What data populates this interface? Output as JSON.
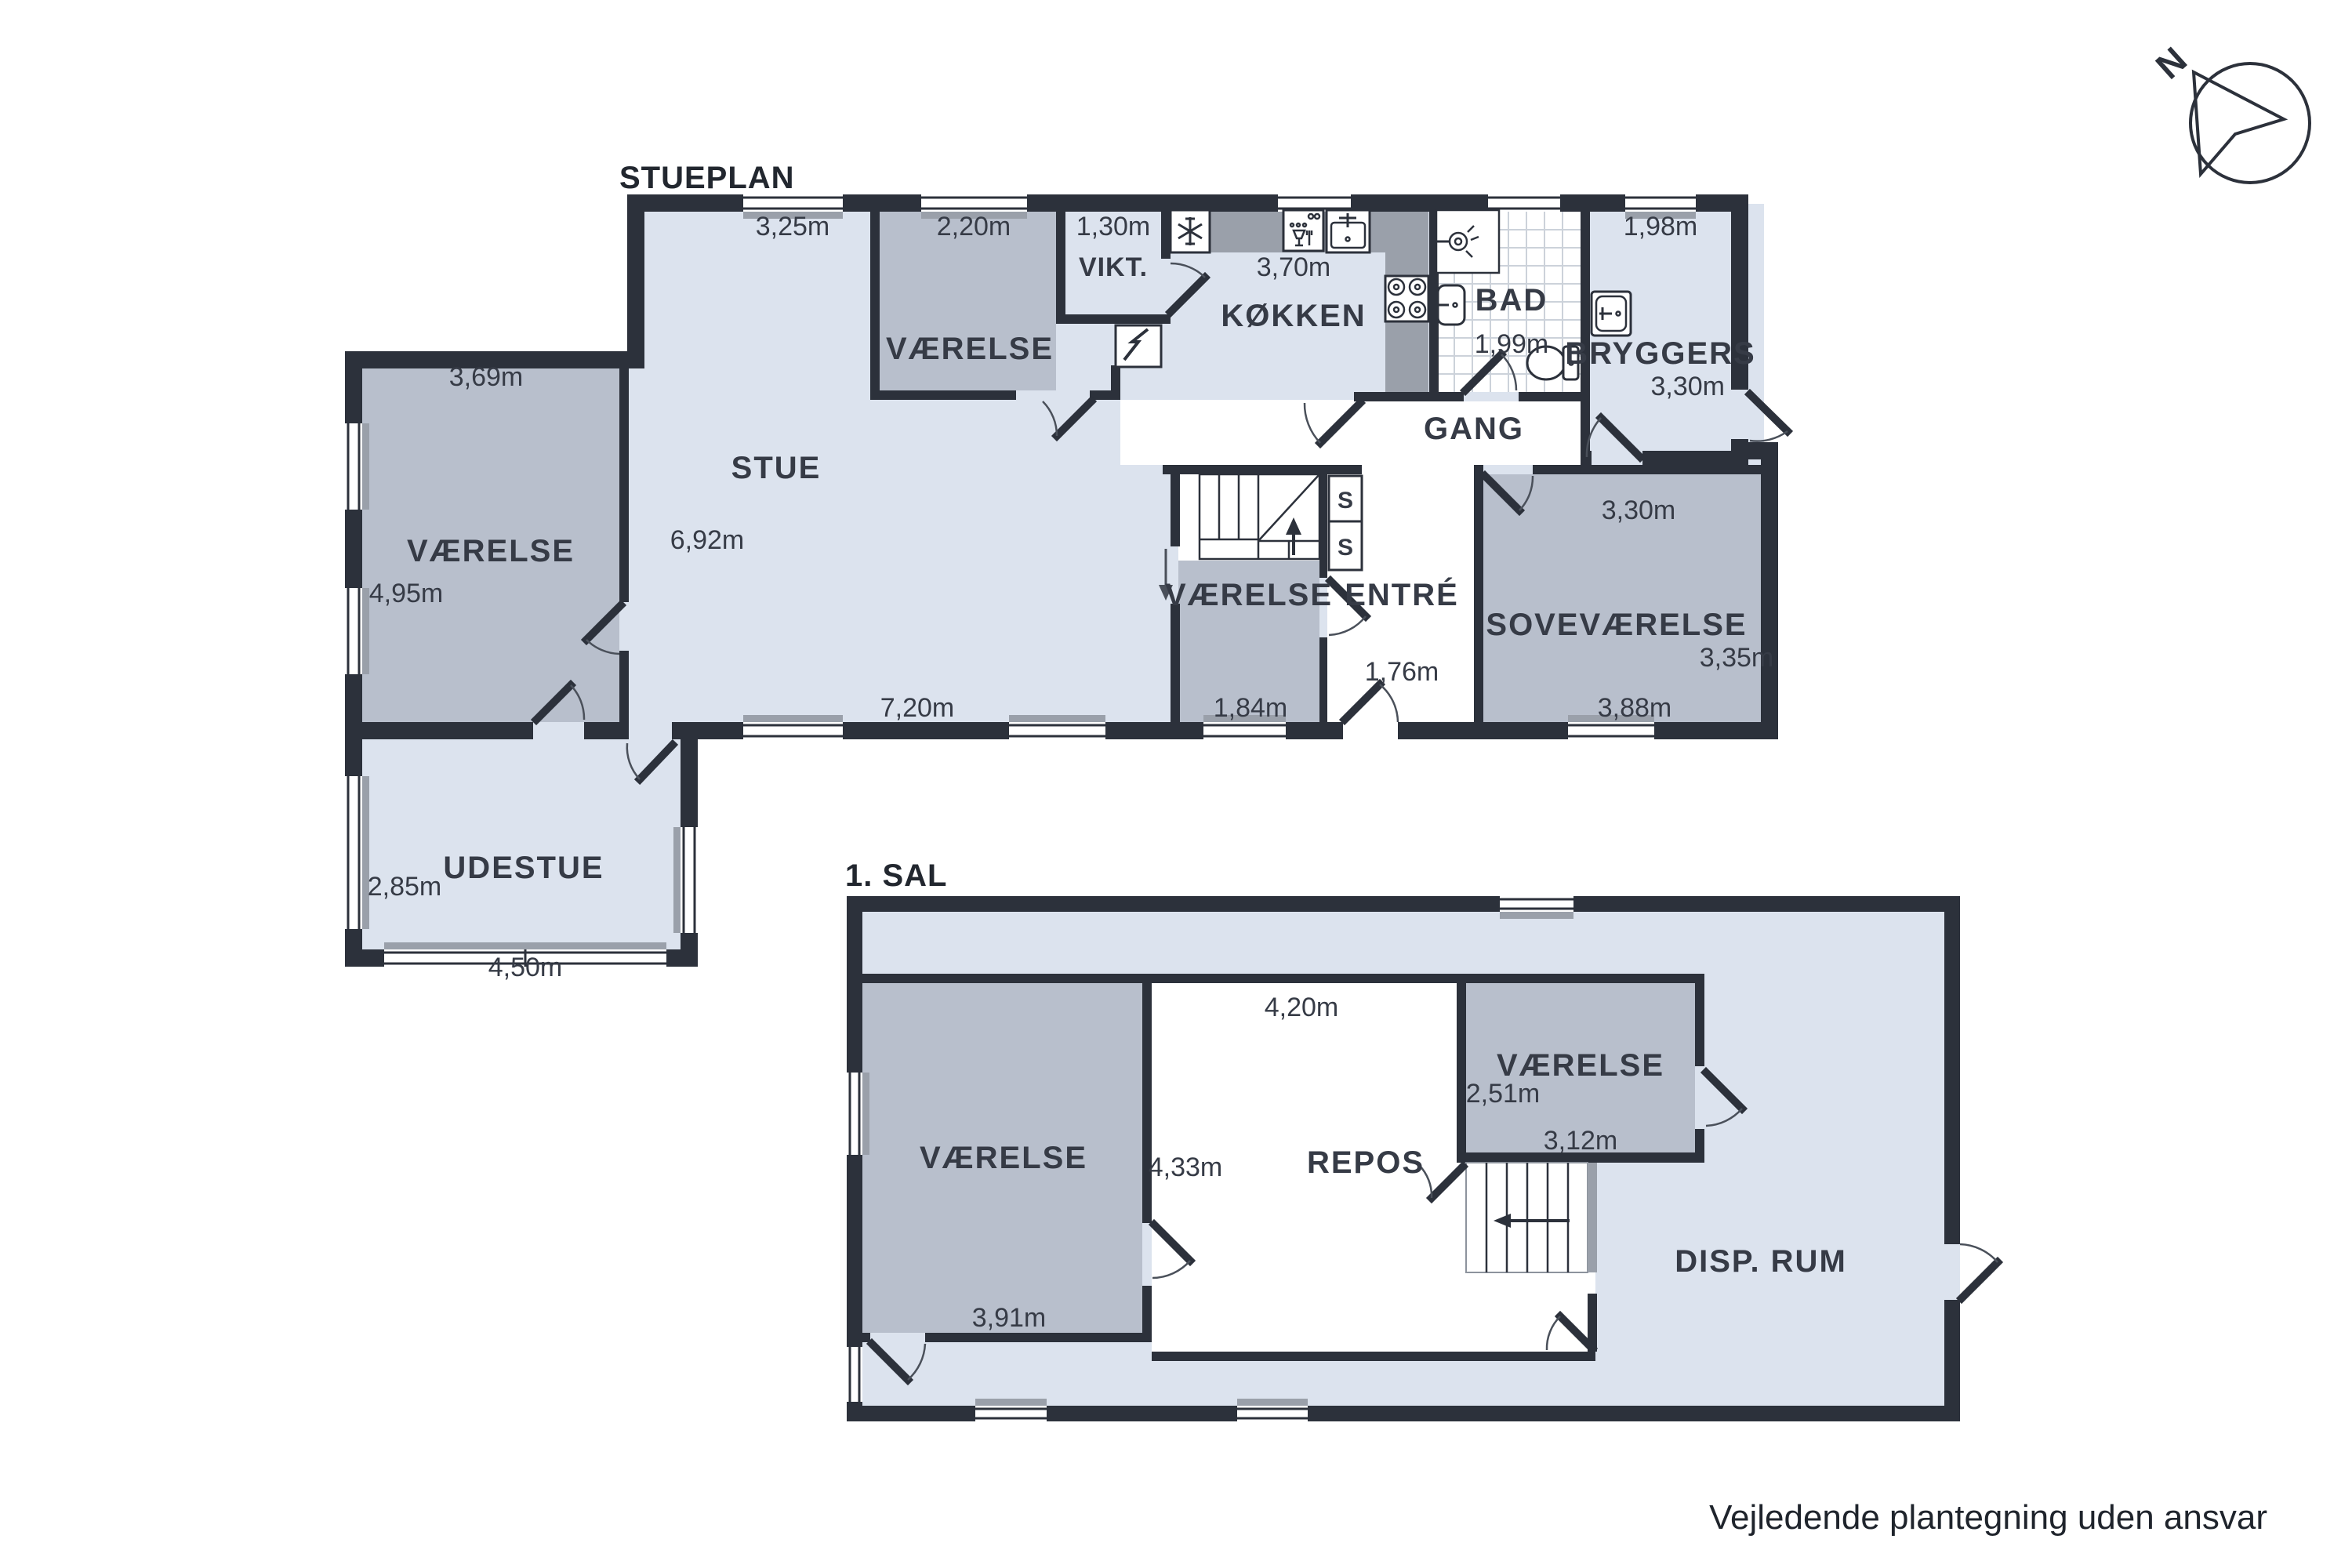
{
  "titles": {
    "ground": "STUEPLAN",
    "first": "1. SAL"
  },
  "footer": {
    "disclaimer": "Vejledende plantegning uden ansvar"
  },
  "compass": {
    "north": "N"
  },
  "ground": {
    "stue": {
      "name": "STUE",
      "dim_top": "3,25m",
      "dim_left": "6,92m",
      "dim_bottom": "7,20m"
    },
    "vaerelse_top": {
      "name": "VÆRELSE",
      "dim_top": "2,20m"
    },
    "vikt": {
      "name": "VIKT.",
      "dim_top": "1,30m"
    },
    "kokken": {
      "name": "KØKKEN",
      "dim_top": "3,70m"
    },
    "bad": {
      "name": "BAD",
      "dim": "1,99m"
    },
    "bryggers": {
      "name": "BRYGGERS",
      "dim_top": "1,98m",
      "dim_side": "3,30m"
    },
    "gang": {
      "name": "GANG"
    },
    "sovevaerelse": {
      "name": "SOVEVÆRELSE",
      "dim_top": "3,30m",
      "dim_side": "3,35m",
      "dim_bottom": "3,88m"
    },
    "vaerelse_mid": {
      "name": "VÆRELSE",
      "dim_bottom": "1,84m"
    },
    "entre": {
      "name": "ENTRÉ",
      "dim": "1,76m"
    },
    "vaerelse_left": {
      "name": "VÆRELSE",
      "dim_top": "3,69m",
      "dim_side": "4,95m"
    },
    "udestue": {
      "name": "UDESTUE",
      "dim_side": "2,85m",
      "dim_bottom": "4,50m"
    },
    "closet_label": "S"
  },
  "first": {
    "vaerelse_left": {
      "name": "VÆRELSE",
      "dim_bottom": "3,91m"
    },
    "repos": {
      "name": "REPOS",
      "dim_top": "4,20m",
      "dim_left": "4,33m"
    },
    "vaerelse_right": {
      "name": "VÆRELSE",
      "dim_side": "2,51m",
      "dim_bottom": "3,12m"
    },
    "disp_rum": {
      "name": "DISP. RUM"
    }
  }
}
